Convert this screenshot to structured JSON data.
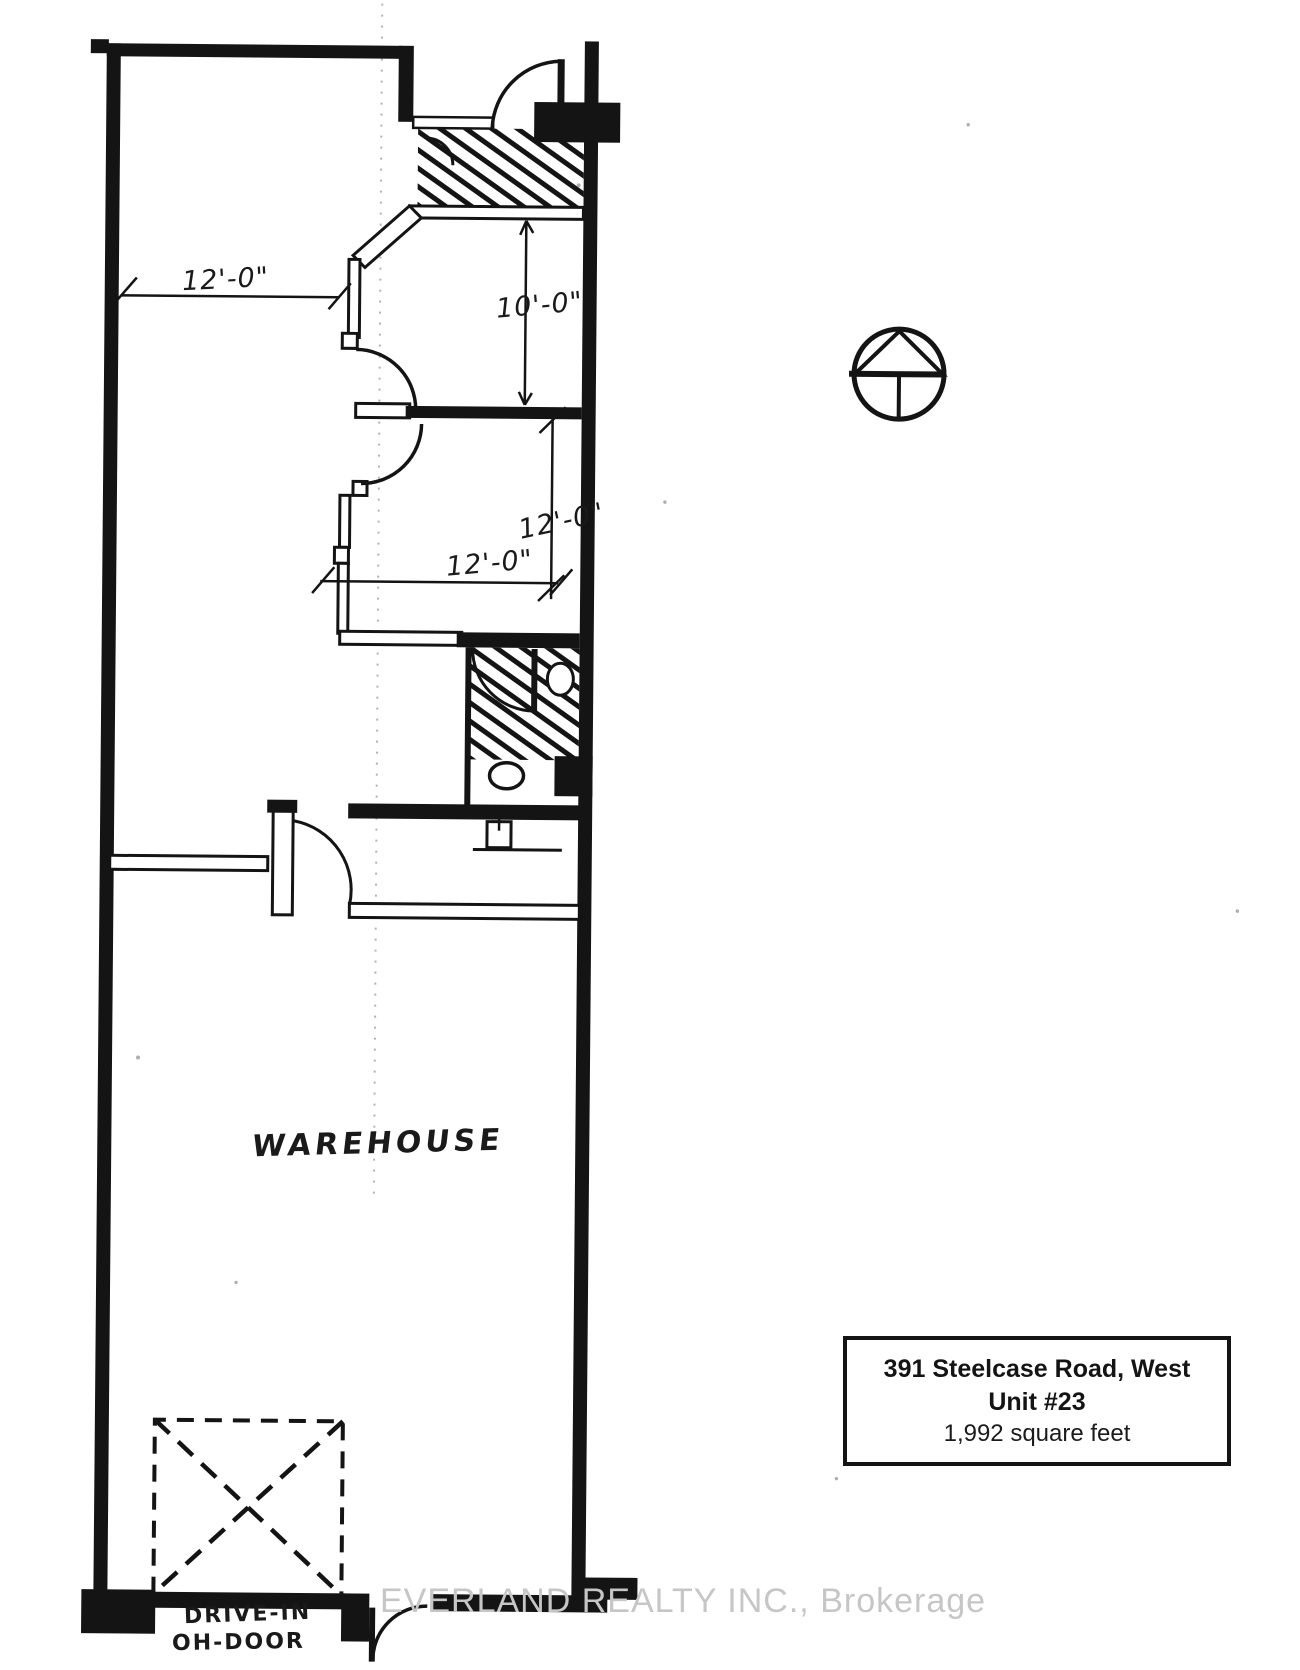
{
  "plan": {
    "labels": {
      "warehouse": "WAREHOUSE",
      "drive_in_line1": "DRIVE-IN",
      "drive_in_line2": "OH-DOOR"
    },
    "dimensions": {
      "front_width": "12'-0\"",
      "office1_depth": "10'-0\"",
      "office2_depth": "12'-0\"",
      "office2_width": "12'-0\""
    },
    "icons": {
      "north_arrow": "north-arrow"
    }
  },
  "info_box": {
    "address": "391 Steelcase Road, West",
    "unit": "Unit #23",
    "area": "1,992 square feet"
  },
  "watermark": "EVERLAND REALTY INC., Brokerage",
  "colors": {
    "ink": "#141414",
    "watermark_gray": "#c6c6c6",
    "crease_gray": "#8a8a8a",
    "paper": "#ffffff"
  }
}
